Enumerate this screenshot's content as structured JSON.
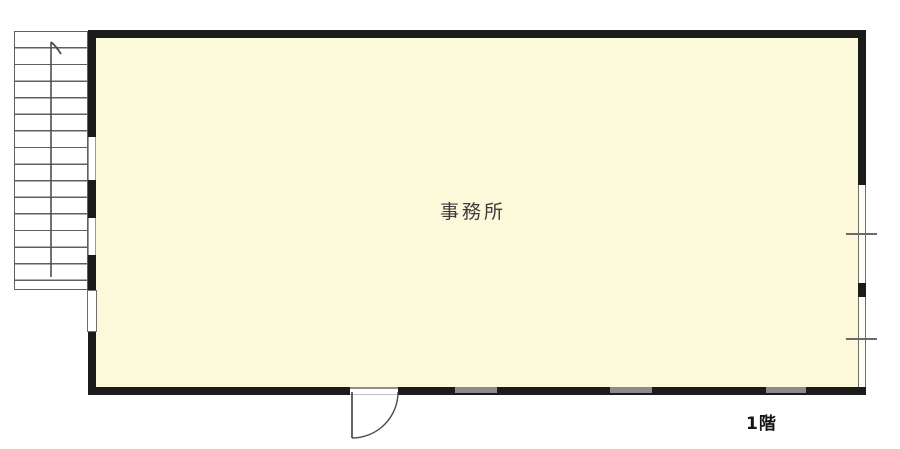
{
  "floor_plan": {
    "room": {
      "label": "事務所",
      "fill_color": "#fcf8da"
    },
    "floor_label": "1階",
    "stairs": {
      "icon": "staircase-icon",
      "direction_arrow": "up"
    },
    "door": {
      "icon": "swing-door-icon",
      "wall": "bottom"
    },
    "windows": {
      "left_wall_openings": 3,
      "right_wall_windows": 2,
      "bottom_wall_windows": 3
    },
    "colors": {
      "wall": "#1b1b1b",
      "window_gray": "#8c8c8c",
      "line": "#5f5f5f",
      "text": "#3c3c3c"
    }
  }
}
